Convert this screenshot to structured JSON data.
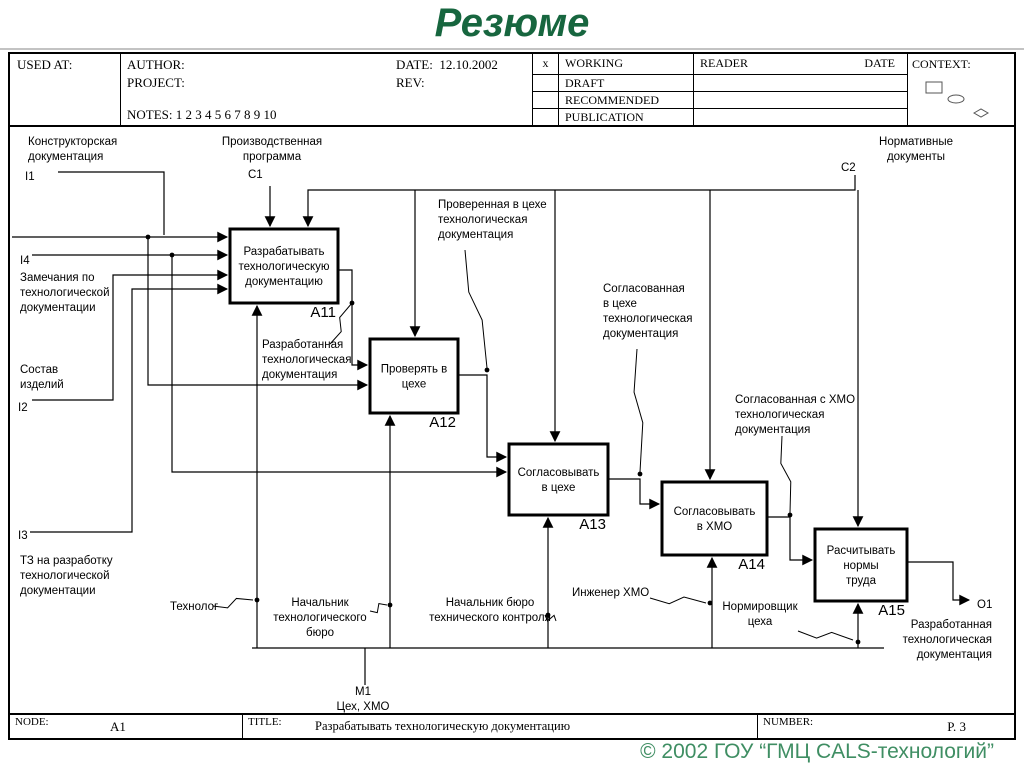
{
  "slide": {
    "title": "Резюме",
    "title_color": "#17663f",
    "copyright": "© 2002 ГОУ “ГМЦ CALS-технологий”",
    "copyright_color": "#3f8e63"
  },
  "idef_header": {
    "used_at": "USED AT:",
    "author": "AUTHOR:",
    "project": "PROJECT:",
    "notes": "NOTES:  1  2  3  4  5  6  7  8  9  10",
    "date_label": "DATE:",
    "date_value": "12.10.2002",
    "rev_label": "REV:",
    "x_mark": "x",
    "status_rows": [
      "WORKING",
      "DRAFT",
      "RECOMMENDED",
      "PUBLICATION"
    ],
    "reader": "READER",
    "reader_date": "DATE",
    "context": "CONTEXT:"
  },
  "idef_footer": {
    "node_label": "NODE:",
    "node_value": "A1",
    "title_label": "TITLE:",
    "title_value": "Разрабатывать технологическую документацию",
    "number_label": "NUMBER:",
    "number_value": "P. 3"
  },
  "diagram": {
    "boxes": [
      {
        "name": "a11",
        "code": "A11",
        "lines": [
          "Разрабатывать",
          "технологическую",
          "документацию"
        ],
        "x": 230,
        "y": 227,
        "w": 108,
        "h": 74
      },
      {
        "name": "a12",
        "code": "A12",
        "lines": [
          "Проверять в",
          "цехе"
        ],
        "x": 370,
        "y": 337,
        "w": 88,
        "h": 74
      },
      {
        "name": "a13",
        "code": "A13",
        "lines": [
          "Согласовывать",
          "в цехе"
        ],
        "x": 509,
        "y": 442,
        "w": 99,
        "h": 71
      },
      {
        "name": "a14",
        "code": "A14",
        "lines": [
          "Согласовывать",
          "в ХМО"
        ],
        "x": 662,
        "y": 480,
        "w": 105,
        "h": 73
      },
      {
        "name": "a15",
        "code": "A15",
        "lines": [
          "Расчитывать",
          "нормы",
          "труда"
        ],
        "x": 815,
        "y": 527,
        "w": 92,
        "h": 72
      }
    ],
    "wires": [
      {
        "name": "c1-control-a11",
        "pts": [
          [
            270,
            184
          ],
          [
            270,
            224
          ]
        ],
        "arrow": true
      },
      {
        "name": "c2-control-main-a11",
        "pts": [
          [
            855,
            173
          ],
          [
            855,
            188
          ],
          [
            308,
            188
          ],
          [
            308,
            224
          ]
        ],
        "arrow": true
      },
      {
        "name": "c2-drop-a12",
        "pts": [
          [
            415,
            188
          ],
          [
            415,
            334
          ]
        ],
        "arrow": true
      },
      {
        "name": "c2-drop-a13",
        "pts": [
          [
            555,
            188
          ],
          [
            555,
            439
          ]
        ],
        "arrow": true
      },
      {
        "name": "c2-drop-a14",
        "pts": [
          [
            710,
            188
          ],
          [
            710,
            477
          ]
        ],
        "arrow": true
      },
      {
        "name": "c2-drop-a15",
        "pts": [
          [
            858,
            188
          ],
          [
            858,
            524
          ]
        ],
        "arrow": true
      },
      {
        "name": "i1-input-a11",
        "pts": [
          [
            12,
            235
          ],
          [
            227,
            235
          ]
        ],
        "arrow": true
      },
      {
        "name": "i1-label-elbow",
        "pts": [
          [
            58,
            170
          ],
          [
            164,
            170
          ],
          [
            164,
            233
          ]
        ],
        "arrow": false
      },
      {
        "name": "i1-branch-a12",
        "pts": [
          [
            148,
            235
          ],
          [
            148,
            383
          ],
          [
            367,
            383
          ]
        ],
        "arrow": true
      },
      {
        "name": "i4-input-a11",
        "pts": [
          [
            32,
            253
          ],
          [
            227,
            253
          ]
        ],
        "arrow": true
      },
      {
        "name": "i4-branch-a13",
        "pts": [
          [
            172,
            253
          ],
          [
            172,
            470
          ],
          [
            506,
            470
          ]
        ],
        "arrow": true
      },
      {
        "name": "i2-input-a11",
        "pts": [
          [
            32,
            398
          ],
          [
            113,
            398
          ],
          [
            113,
            273
          ],
          [
            227,
            273
          ]
        ],
        "arrow": true
      },
      {
        "name": "i3-input-a11",
        "pts": [
          [
            30,
            530
          ],
          [
            132,
            530
          ],
          [
            132,
            287
          ],
          [
            227,
            287
          ]
        ],
        "arrow": true
      },
      {
        "name": "a11-out-a12",
        "pts": [
          [
            338,
            268
          ],
          [
            352,
            268
          ],
          [
            352,
            363
          ],
          [
            367,
            363
          ]
        ],
        "arrow": true
      },
      {
        "name": "a12-out-a13",
        "pts": [
          [
            458,
            373
          ],
          [
            487,
            373
          ],
          [
            487,
            455
          ],
          [
            506,
            455
          ]
        ],
        "arrow": true
      },
      {
        "name": "a13-out-a14",
        "pts": [
          [
            608,
            477
          ],
          [
            640,
            477
          ],
          [
            640,
            502
          ],
          [
            659,
            502
          ]
        ],
        "arrow": true
      },
      {
        "name": "a14-out-a15",
        "pts": [
          [
            767,
            515
          ],
          [
            790,
            515
          ],
          [
            790,
            558
          ],
          [
            812,
            558
          ]
        ],
        "arrow": true
      },
      {
        "name": "a15-out-o1",
        "pts": [
          [
            907,
            560
          ],
          [
            953,
            560
          ],
          [
            953,
            598
          ],
          [
            969,
            598
          ]
        ],
        "arrow": true
      },
      {
        "name": "mech-a11",
        "pts": [
          [
            257,
            646
          ],
          [
            257,
            304
          ]
        ],
        "arrow": true
      },
      {
        "name": "mech-a12",
        "pts": [
          [
            390,
            646
          ],
          [
            390,
            414
          ]
        ],
        "arrow": true
      },
      {
        "name": "mech-a13",
        "pts": [
          [
            548,
            646
          ],
          [
            548,
            516
          ]
        ],
        "arrow": true
      },
      {
        "name": "mech-a14",
        "pts": [
          [
            712,
            646
          ],
          [
            712,
            556
          ]
        ],
        "arrow": true
      },
      {
        "name": "mech-a15",
        "pts": [
          [
            858,
            646
          ],
          [
            858,
            602
          ]
        ],
        "arrow": true
      },
      {
        "name": "mech-bus",
        "pts": [
          [
            252,
            646
          ],
          [
            884,
            646
          ]
        ],
        "arrow": false
      },
      {
        "name": "mech-m1-drop",
        "pts": [
          [
            365,
            646
          ],
          [
            365,
            683
          ]
        ],
        "arrow": false
      }
    ],
    "labels": [
      {
        "name": "label-konstruktorskaya",
        "x": 28,
        "y": 143,
        "align": "start",
        "lines": [
          "Конструкторская",
          "документация"
        ]
      },
      {
        "name": "icom-i1",
        "x": 25,
        "y": 178,
        "align": "start",
        "lines": [
          "I1"
        ]
      },
      {
        "name": "label-proizvodstvennaya",
        "x": 272,
        "y": 143,
        "align": "middle",
        "lines": [
          "Производственная",
          "программа"
        ]
      },
      {
        "name": "icom-c1",
        "x": 248,
        "y": 176,
        "align": "start",
        "lines": [
          "C1"
        ]
      },
      {
        "name": "label-normativnye",
        "x": 916,
        "y": 143,
        "align": "middle",
        "lines": [
          "Нормативные",
          "документы"
        ]
      },
      {
        "name": "icom-c2",
        "x": 841,
        "y": 169,
        "align": "start",
        "lines": [
          "C2"
        ]
      },
      {
        "name": "icom-i4",
        "x": 20,
        "y": 262,
        "align": "start",
        "lines": [
          "I4"
        ]
      },
      {
        "name": "label-zamechaniya",
        "x": 20,
        "y": 279,
        "align": "start",
        "lines": [
          "Замечания по",
          "технологической",
          "документации"
        ]
      },
      {
        "name": "label-sostav",
        "x": 20,
        "y": 371,
        "align": "start",
        "lines": [
          "Состав",
          "изделий"
        ]
      },
      {
        "name": "icom-i2",
        "x": 18,
        "y": 409,
        "align": "start",
        "lines": [
          "I2"
        ]
      },
      {
        "name": "icom-i3",
        "x": 18,
        "y": 537,
        "align": "start",
        "lines": [
          "I3"
        ]
      },
      {
        "name": "label-tz",
        "x": 20,
        "y": 562,
        "align": "start",
        "lines": [
          "ТЗ на разработку",
          "технологической",
          "документации"
        ]
      },
      {
        "name": "label-razrabotannaya-left",
        "x": 262,
        "y": 346,
        "align": "start",
        "lines": [
          "Разработанная",
          "технологическая",
          "документация"
        ]
      },
      {
        "name": "label-proverennaya",
        "x": 438,
        "y": 206,
        "align": "start",
        "lines": [
          "Проверенная в цехе",
          "технологическая",
          "документация"
        ]
      },
      {
        "name": "label-soglasovannaya-tsekh",
        "x": 603,
        "y": 290,
        "align": "start",
        "lines": [
          "Согласованная",
          "в цехе",
          "технологическая",
          "документация"
        ]
      },
      {
        "name": "label-soglasovannaya-khmo",
        "x": 735,
        "y": 401,
        "align": "start",
        "lines": [
          "Согласованная с ХМО",
          "технологическая",
          "документация"
        ]
      },
      {
        "name": "label-tekhnolog",
        "x": 170,
        "y": 608,
        "align": "start",
        "lines": [
          "Технолог"
        ]
      },
      {
        "name": "label-nach-tekhbyuro",
        "x": 320,
        "y": 604,
        "align": "middle",
        "lines": [
          "Начальник",
          "технологического",
          "бюро"
        ]
      },
      {
        "name": "label-nach-byuro-kontrolya",
        "x": 490,
        "y": 604,
        "align": "middle",
        "lines": [
          "Начальник бюро",
          "технического контроля"
        ]
      },
      {
        "name": "label-inzhener-khmo",
        "x": 572,
        "y": 594,
        "align": "start",
        "lines": [
          "Инженер ХМО"
        ]
      },
      {
        "name": "label-normirovshchik",
        "x": 760,
        "y": 608,
        "align": "middle",
        "lines": [
          "Нормировщик",
          "цеха"
        ]
      },
      {
        "name": "icom-m1",
        "x": 363,
        "y": 693,
        "align": "middle",
        "lines": [
          "M1"
        ]
      },
      {
        "name": "label-tsekh-khmo",
        "x": 363,
        "y": 708,
        "align": "middle",
        "lines": [
          "Цех, ХМО"
        ]
      },
      {
        "name": "icom-o1",
        "x": 977,
        "y": 606,
        "align": "start",
        "lines": [
          "O1"
        ]
      },
      {
        "name": "label-razrabotannaya-right",
        "x": 992,
        "y": 626,
        "align": "end",
        "lines": [
          "Разработанная",
          "технологическая",
          "документация"
        ]
      }
    ],
    "leaders": [
      {
        "name": "leader-razrabotannaya",
        "from": [
          330,
          342
        ],
        "to": [
          352,
          301
        ]
      },
      {
        "name": "leader-proverennaya",
        "from": [
          465,
          248
        ],
        "to": [
          487,
          366
        ]
      },
      {
        "name": "leader-soglasovannaya-tsekh",
        "from": [
          637,
          347
        ],
        "to": [
          640,
          470
        ]
      },
      {
        "name": "leader-soglasovannaya-khmo",
        "from": [
          782,
          434
        ],
        "to": [
          790,
          511
        ]
      },
      {
        "name": "leader-tekhnolog",
        "from": [
          213,
          604
        ],
        "to": [
          253,
          598
        ]
      },
      {
        "name": "leader-nach-tekhbyuro",
        "from": [
          370,
          609
        ],
        "to": [
          387,
          603
        ]
      },
      {
        "name": "leader-nach-kontrolya",
        "from": [
          556,
          619
        ],
        "to": [
          545,
          613
        ]
      },
      {
        "name": "leader-inzhener",
        "from": [
          650,
          596
        ],
        "to": [
          706,
          601
        ]
      },
      {
        "name": "leader-normirovshchik",
        "from": [
          798,
          629
        ],
        "to": [
          853,
          638
        ]
      }
    ],
    "dots": [
      [
        148,
        235
      ],
      [
        172,
        253
      ],
      [
        352,
        301
      ],
      [
        487,
        368
      ],
      [
        640,
        472
      ],
      [
        790,
        513
      ],
      [
        257,
        598
      ],
      [
        390,
        603
      ],
      [
        548,
        613
      ],
      [
        710,
        601
      ],
      [
        858,
        640
      ]
    ]
  }
}
